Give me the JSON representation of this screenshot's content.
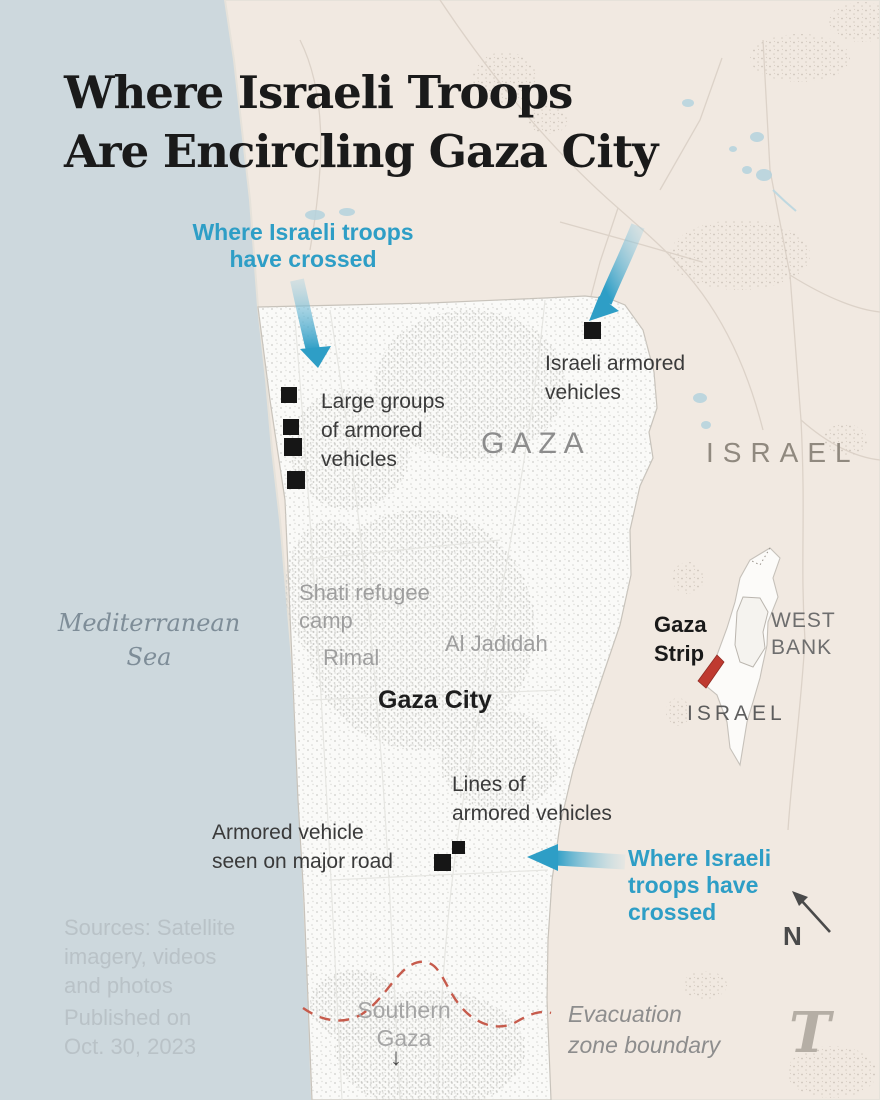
{
  "title": {
    "lines": [
      "Where Israeli Troops",
      "Are Encircling Gaza City"
    ]
  },
  "annotations": {
    "crossed_top": {
      "lines": [
        "Where Israeli troops",
        "have crossed"
      ]
    },
    "crossed_bottom": {
      "lines": [
        "Where Israeli",
        "troops have",
        "crossed"
      ]
    },
    "israeli_armored": {
      "lines": [
        "Israeli armored",
        "vehicles"
      ]
    },
    "large_groups": {
      "lines": [
        "Large groups",
        "of armored",
        "vehicles"
      ]
    },
    "lines_of_armored": {
      "lines": [
        "Lines of",
        "armored vehicles"
      ]
    },
    "armored_major_road": {
      "lines": [
        "Armored vehicle",
        "seen on major road"
      ]
    },
    "evacuation_zone": {
      "lines": [
        "Evacuation",
        "zone boundary"
      ]
    },
    "southern_gaza": {
      "lines": [
        "Southern",
        "Gaza"
      ],
      "arrow": "↓"
    }
  },
  "places": {
    "gaza_region": "GAZA",
    "israel_region": "ISRAEL",
    "shati": {
      "lines": [
        "Shati refugee",
        "camp"
      ]
    },
    "rimal": "Rimal",
    "al_jadidah": "Al Jadidah",
    "gaza_city": "Gaza City",
    "mediterranean": {
      "lines": [
        "Mediterranean",
        "Sea"
      ]
    }
  },
  "inset": {
    "gaza_strip": {
      "lines": [
        "Gaza",
        "Strip"
      ]
    },
    "west_bank": {
      "lines": [
        "WEST",
        "BANK"
      ]
    },
    "israel": "ISRAEL"
  },
  "footer": {
    "sources": {
      "lines": [
        "Sources: Satellite",
        "imagery, videos",
        "and photos"
      ]
    },
    "published": {
      "lines": [
        "Published on",
        "Oct. 30, 2023"
      ]
    },
    "logo": "T"
  },
  "compass": {
    "label": "N"
  },
  "colors": {
    "sea": "#cdd8dd",
    "land": "#f1e9e1",
    "gaza_strip_fill": "#fafaf8",
    "accent_blue": "#2e9ec6",
    "marker_black": "#161616",
    "evacuation_red": "#c65b4c",
    "inset_gaza_red": "#bf3a30",
    "title_text": "#1a1a1a",
    "gray_label": "#9e9e9e"
  }
}
